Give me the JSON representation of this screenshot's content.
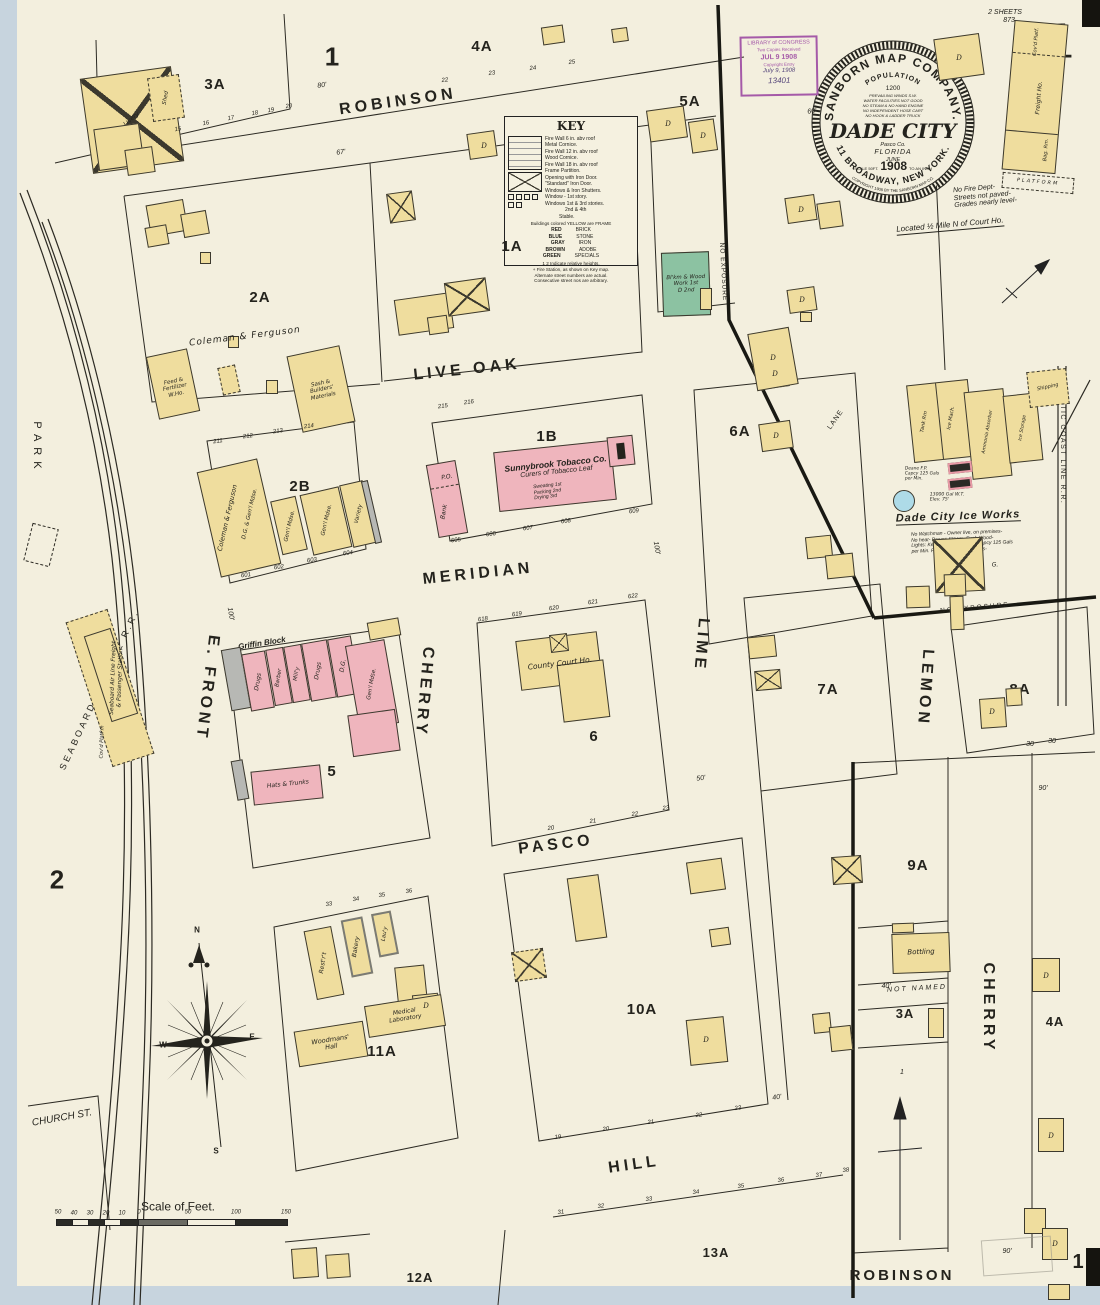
{
  "page": {
    "big1": "1",
    "sheets": "2 SHEETS",
    "sheets2": "873.",
    "p1": "1",
    "p2": "2",
    "pbr": "1"
  },
  "seal": {
    "arc_top": "SANBORN MAP COMPANY.",
    "population": "POPULATION",
    "pop_value": "1200",
    "note1": "PREVAILING WINDS S.W.",
    "note2": "WATER FACILITIES NOT GOOD",
    "note3": "NO STEAM & NO HAND ENGINE",
    "note4": "NO INDEPENDENT HOSE CART",
    "note5": "NO HOOK & LADDER TRUCK",
    "city": "DADE CITY",
    "county": "Pasco Co.",
    "state": "FLORIDA",
    "month": "JUNE",
    "scale_pre": "SCALE 50FT.",
    "year": "1908",
    "scale_post": "TO AN INCH",
    "arc_bottom": "11 BROADWAY, NEW YORK.",
    "copyright": "COPYRIGHT 1908 BY THE SANBORN MAP CO."
  },
  "stamp": {
    "l1": "LIBRARY of CONGRESS",
    "l2": "Two Copies Received",
    "l3": "JUL 9 1908",
    "l4": "Copyright Entry",
    "hw1": "July 9, 1908",
    "hw2": "13401"
  },
  "notes": {
    "fire1": "No Fire Dept-",
    "fire2": "Streets not paved-",
    "fire3": "Grades nearly level-",
    "located": "Located ½ Mile N of Court Ho."
  },
  "key": {
    "title": "KEY",
    "lines": [
      "Fire Wall 6 in. abv roof",
      "Metal Cornice.",
      "Fire Wall 12 in. abv roof",
      "Wood Cornice.",
      "Fire Wall 18 in. abv roof",
      "Frame Partition.",
      "Opening with Iron Door.",
      "\"Standard\" Iron Door.",
      "Windows & Iron Shutters.",
      "Window - 1st story.",
      "Windows 1st & 3rd stories.",
      "2nd & 4th",
      "Stable."
    ],
    "frame_note": "Buildings colored YELLOW are FRAME",
    "colors": [
      [
        "RED",
        "BRICK"
      ],
      [
        "BLUE",
        "STONE"
      ],
      [
        "GRAY",
        "IRON"
      ],
      [
        "BROWN",
        "ADOBE"
      ],
      [
        "GREEN",
        "SPECIALS"
      ]
    ],
    "f1": "1 2 Indicate relative heights.",
    "f2": "+ Fire Station, as shown on Key map.",
    "f3": "Alternate street numbers are actual.",
    "f4": "Consecutive street nos are arbitrary."
  },
  "streets": {
    "robinson_top": "ROBINSON",
    "live_oak": "LIVE OAK",
    "meridian": "MERIDIAN",
    "pasco": "PASCO",
    "hill": "HILL",
    "robinson_bottom": "ROBINSON",
    "e_front": "E. FRONT",
    "cherry_w": "CHERRY",
    "lime": "LIME",
    "lemon": "LEMON",
    "cherry_e": "CHERRY",
    "park": "PARK",
    "church": "CHURCH ST.",
    "lane": "LANE",
    "not_named": "NOT NAMED"
  },
  "rail": {
    "seaboard": "SEABOARD AIR LINE R.R.",
    "acl": "ATLANTIC COAST LINE R.R.",
    "noexp_diag": "NO EXPOSURE",
    "noexp_s": "NO EXPOSURE"
  },
  "blocks": {
    "b3a": "3A",
    "b1": "1",
    "b4a": "4A",
    "b5a": "5A",
    "b1a": "1A",
    "b2a": "2A",
    "b2b": "2B",
    "b1b": "1B",
    "b6a": "6A",
    "b7a": "7A",
    "b8a": "8A",
    "b5": "5",
    "b6": "6",
    "b2": "2",
    "b9a": "9A",
    "b10a": "10A",
    "b11a": "11A",
    "b3a_s": "3A",
    "b4a_s": "4A",
    "b12a": "12A",
    "b13a": "13A"
  },
  "bldg": {
    "livery": "Livery",
    "shed": "Shed",
    "coleman2a": "Coleman & Ferguson",
    "feed1": "Feed &",
    "feed2": "Fertilizer",
    "feed3": "W.Ho.",
    "sash1": "Sash &",
    "sash2": "Builders'",
    "sash3": "Materials",
    "coleman2b": "Coleman & Ferguson",
    "dg_genl": "D.G. & Gen'l Mdse.",
    "genl1": "Gen'l Mdse.",
    "genl2": "Gen'l Mdse.",
    "variety": "Variety",
    "po": "P.O.",
    "bank": "Bank",
    "sun1": "Sunnybrook Tobacco Co.",
    "sun2": "Curers of Tobacco Leaf",
    "sun3": "Sweating 1st",
    "sun4": "Packing 2nd",
    "sun5": "Drying 3rd",
    "griffin": "Griffin Block",
    "drugs1": "Drugs",
    "barber": "Barber",
    "milly": "Mill'y",
    "drugs2": "Drugs",
    "dg": "D.G.",
    "genl3": "Gen'l Mdse.",
    "hats": "Hats & Trunks",
    "court": "County Court Ho.",
    "wood1": "Woodmans'",
    "wood2": "Hall",
    "med1": "Medical",
    "med2": "Laboratory",
    "restrt": "Rest'r't",
    "bakery": "Bakery",
    "lauy": "Lau'y",
    "bottling": "Bottling",
    "bsmith1": "Bl'km & Wood",
    "bsmith2": "Work 1st",
    "bsmith3": "D 2nd",
    "d": "D",
    "g": "G."
  },
  "station": {
    "l1": "Seaboard Air Line Freight",
    "l2": "& Passenger Station",
    "covd": "Cov'd Platf'm"
  },
  "freight": {
    "covd": "Cov'd Platf.",
    "main": "Freight Ho.",
    "bag": "Bag. Rm.",
    "platform": "PLATFORM"
  },
  "ice": {
    "title": "Dade City Ice Works",
    "tank": "Tank Rm",
    "mach": "Ice Mach.",
    "amm": "Ammonia Absorber",
    "sto": "Ice Storage",
    "ship": "Shipping",
    "wt1": "13000 Gal W.T.",
    "wt2": "Elev. 75'",
    "deane1": "Deane F.P.",
    "deane2": "Capcy 125 Gals",
    "deane3": "per Min.",
    "n1": "No Watchman - Owner live, on premises-",
    "n2": "No heat- Power: Steam- Fuel: Wood-",
    "n3": "Lights: Kerosene- Deane F.P. Capcy 125 Gals",
    "n4": "per Min. Fig. 5 Hose- Water Pails-"
  },
  "nums": {
    "rob4a": [
      "22",
      "23",
      "24",
      "25"
    ],
    "b3a": [
      "15",
      "16",
      "17",
      "18",
      "19",
      "20"
    ],
    "b2b_t": [
      "211",
      "212",
      "213",
      "214"
    ],
    "b2b_b": [
      "601",
      "602",
      "603",
      "604"
    ],
    "b1b_t": [
      "215",
      "216"
    ],
    "b1b_b": [
      "605",
      "606",
      "607",
      "608",
      "609"
    ],
    "b6_t": [
      "618",
      "619",
      "620",
      "621",
      "622"
    ],
    "b6_b": [
      "20",
      "21",
      "22",
      "23"
    ],
    "hill_n": [
      "19",
      "20",
      "21",
      "22",
      "23"
    ],
    "hill_s": [
      "31",
      "32",
      "33",
      "34",
      "35",
      "36",
      "37",
      "38"
    ],
    "b11a": [
      "33",
      "34",
      "35",
      "36"
    ]
  },
  "dims": [
    "80'",
    "67'",
    "60'",
    "100'",
    "100'",
    "50'",
    "40'",
    "90'",
    "90'",
    "40'",
    "30",
    "30",
    "1"
  ],
  "scalebar": {
    "title": "Scale of Feet.",
    "labels": [
      "50",
      "40",
      "30",
      "20",
      "10",
      "0",
      "50",
      "100",
      "150"
    ]
  },
  "compass": {
    "n": "N",
    "e": "E",
    "w": "W",
    "s": "S"
  }
}
